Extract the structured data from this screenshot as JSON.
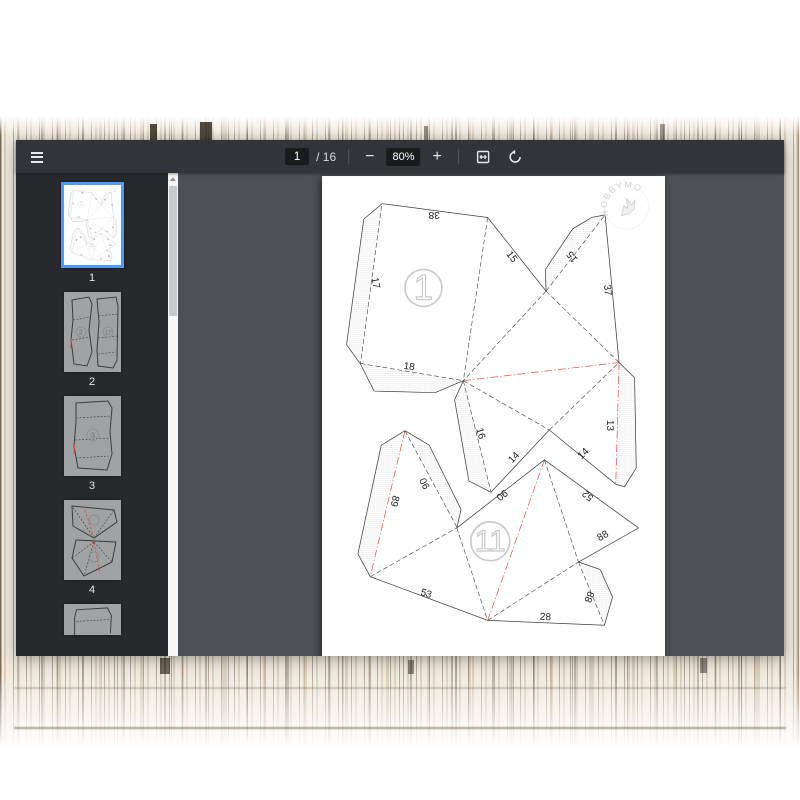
{
  "toolbar": {
    "page_current": "1",
    "page_total_display": "/ 16",
    "minus_label": "−",
    "plus_label": "+",
    "zoom_display": "80%"
  },
  "sidebar": {
    "thumbnails": [
      {
        "label": "1",
        "selected": true
      },
      {
        "label": "2",
        "selected": false,
        "sketch_numbers": [
          "2",
          "17"
        ]
      },
      {
        "label": "3",
        "selected": false,
        "sketch_numbers": [
          "3"
        ]
      },
      {
        "label": "4",
        "selected": false
      },
      {
        "label": "",
        "selected": false,
        "partial": true
      }
    ]
  },
  "page": {
    "watermark": {
      "text": "HOBBYMO",
      "x": 938,
      "y": 96,
      "rot": -28,
      "r": 60
    },
    "colors": {
      "line": "#3f3f3f",
      "dash": "#474747",
      "red": "#e35050",
      "hatch": "#d9d9d9",
      "part_outline": "#c9c9c9",
      "label_text": "#222222",
      "watermark_gray": "#cfcfcf",
      "selected_thumb_border": "#4e9bf5"
    },
    "pattern": {
      "solid": [
        "185,85 510,128",
        "185,85 128,133 75,520 118,580 160,663 348,668 435,631",
        "510,128 690,355",
        "690,355 688,288 772,163 830,128 872,120",
        "872,120 915,575",
        "915,575 963,622 968,900 932,958 903,950",
        "700,783 905,950",
        "435,631 408,690 452,940 520,975",
        "520,975 700,783",
        "255,785 182,830 110,1165 148,1235",
        "255,785 330,830 428,1028 415,1085",
        "148,1235 510,1370",
        "510,1370 870,1385",
        "415,1085 685,875",
        "685,875 975,1085",
        "975,1085 790,1190",
        "790,1190 857,1213 895,1298 870,1385"
      ],
      "dashed": [
        "510,128 435,631",
        "118,578 435,631",
        "183,92 118,578",
        "690,355 872,120",
        "690,355 435,631",
        "690,355 915,575",
        "435,631 700,783",
        "700,783 915,575",
        "435,631 520,973",
        "255,785 415,1082",
        "148,1235 415,1085",
        "415,1085 510,1370",
        "685,875 790,1190",
        "510,1370 790,1190",
        "790,1190 870,1385"
      ],
      "red": [
        "435,631 915,575",
        "915,575 905,948",
        "255,785 148,1235",
        "685,875 510,1370"
      ],
      "hatch": [
        "185,85 128,133 75,520 118,580 183,92",
        "118,580 160,663 348,668 435,631",
        "690,355 688,288 772,163 830,128 872,120",
        "915,575 963,622 968,900 932,958 903,950",
        "255,785 182,830 110,1165 148,1235",
        "255,785 330,830 428,1028 415,1085",
        "790,1190 857,1213 895,1298 870,1385",
        "435,631 408,690 452,940 520,975"
      ],
      "labels": [
        {
          "t": "38",
          "x": 345,
          "y": 118,
          "r": 180
        },
        {
          "t": "15",
          "x": 583,
          "y": 250,
          "r": 52
        },
        {
          "t": "15",
          "x": 772,
          "y": 248,
          "r": 232
        },
        {
          "t": "37",
          "x": 878,
          "y": 352,
          "r": 84
        },
        {
          "t": "17",
          "x": 163,
          "y": 330,
          "r": 80
        },
        {
          "t": "18",
          "x": 268,
          "y": 589,
          "r": 8
        },
        {
          "t": "16",
          "x": 487,
          "y": 794,
          "r": 74
        },
        {
          "t": "14",
          "x": 592,
          "y": 869,
          "r": -47
        },
        {
          "t": "14",
          "x": 806,
          "y": 857,
          "r": -44
        },
        {
          "t": "13",
          "x": 886,
          "y": 769,
          "r": 90
        },
        {
          "t": "52",
          "x": 820,
          "y": 984,
          "r": 220
        },
        {
          "t": "90",
          "x": 318,
          "y": 947,
          "r": 244
        },
        {
          "t": "89",
          "x": 222,
          "y": 1002,
          "r": 104
        },
        {
          "t": "90",
          "x": 553,
          "y": 982,
          "r": 142
        },
        {
          "t": "53",
          "x": 320,
          "y": 1289,
          "r": 17
        },
        {
          "t": "28",
          "x": 688,
          "y": 1361,
          "r": 3
        },
        {
          "t": "88",
          "x": 866,
          "y": 1111,
          "r": -30
        },
        {
          "t": "88",
          "x": 821,
          "y": 1297,
          "r": 112
        }
      ],
      "parts": [
        {
          "t": "1",
          "x": 312,
          "y": 345,
          "r": 57,
          "fs": 108
        },
        {
          "t": "11",
          "x": 518,
          "y": 1126,
          "r": 60,
          "fs": 92
        }
      ]
    }
  }
}
